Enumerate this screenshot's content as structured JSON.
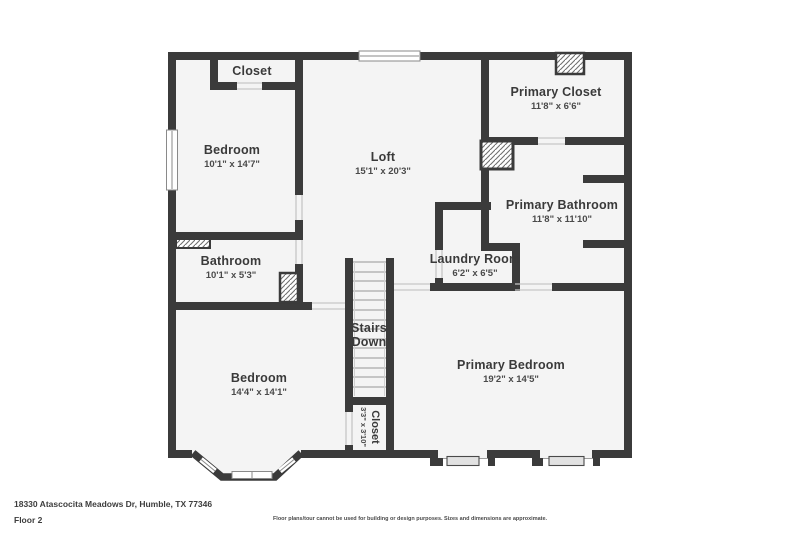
{
  "colors": {
    "wall": "#3b3b3b",
    "floor": "#f4f4f4",
    "hatch": "#707070"
  },
  "rooms": {
    "closet_top": {
      "name": "Closet"
    },
    "bedroom_top": {
      "name": "Bedroom",
      "dims": "10'1\" x 14'7\""
    },
    "loft": {
      "name": "Loft",
      "dims": "15'1\" x 20'3\""
    },
    "primary_closet": {
      "name": "Primary Closet",
      "dims": "11'8\" x 6'6\""
    },
    "primary_bathroom": {
      "name": "Primary Bathroom",
      "dims": "11'8\" x 11'10\""
    },
    "laundry_room": {
      "name": "Laundry Room",
      "dims": "6'2\" x 6'5\""
    },
    "bathroom": {
      "name": "Bathroom",
      "dims": "10'1\" x 5'3\""
    },
    "stairs": {
      "line1": "Stairs",
      "line2": "(Down)"
    },
    "bedroom_bottom": {
      "name": "Bedroom",
      "dims": "14'4\" x 14'1\""
    },
    "primary_bedroom": {
      "name": "Primary Bedroom",
      "dims": "19'2\" x 14'5\""
    },
    "closet_under_stairs": {
      "name": "Closet",
      "dims": "3'3\" x 3'10\""
    }
  },
  "footer": {
    "address": "18330 Atascocita Meadows Dr, Humble, TX 77346",
    "floor_label": "Floor 2",
    "disclaimer": "Floor plans/tour cannot be used for building or design purposes. Sizes and dimensions are approximate."
  }
}
